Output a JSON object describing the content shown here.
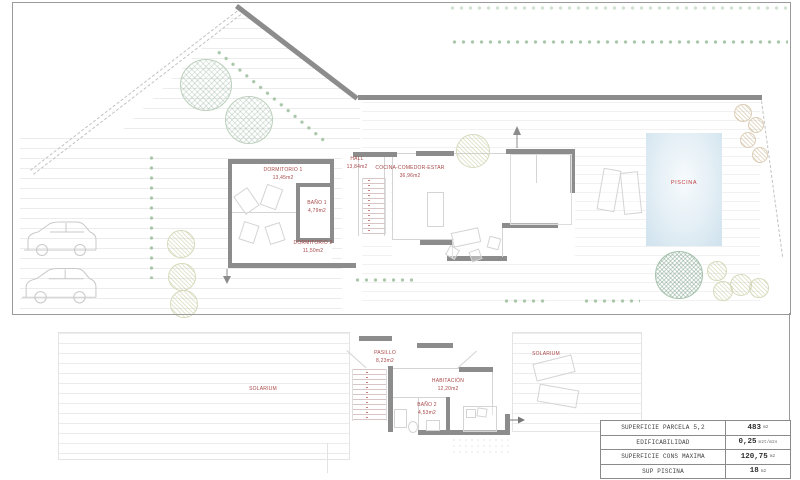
{
  "site_plan": {
    "rooms": [
      {
        "name": "DORMITORIO 1",
        "area": "13,45m2"
      },
      {
        "name": "HALL",
        "area": "13,84m2"
      },
      {
        "name": "COCINA-COMEDOR-ESTAR",
        "area": "36,96m2"
      },
      {
        "name": "BAÑO 1",
        "area": "4,79m2"
      },
      {
        "name": "DORMITORIO 2",
        "area": "11,50m2"
      }
    ],
    "pool_label": "PISCINA"
  },
  "roof_plan": {
    "rooms": [
      {
        "name": "PASILLO",
        "area": "8,23m2"
      },
      {
        "name": "HABITACIÓN",
        "area": "12,20m2"
      },
      {
        "name": "BAÑO 2",
        "area": "4,53m2"
      }
    ],
    "solarium_left": "SOLARIUM",
    "solarium_right": "SOLARIUM"
  },
  "summary_table": {
    "rows": [
      {
        "label": "SUPERFICIE PARCELA 5,2",
        "value": "483",
        "unit": "m2"
      },
      {
        "label": "EDIFICABILIDAD",
        "value": "0,25",
        "unit": "m2t/m2s"
      },
      {
        "label": "SUPERFICIE CONS MAXIMA",
        "value": "120,75",
        "unit": "m2"
      },
      {
        "label": "SUP PISCINA",
        "value": "18",
        "unit": "m2"
      }
    ]
  },
  "colors": {
    "wall": "#8c8c8c",
    "room_label": "#a84848",
    "pool_label": "#c04040",
    "pool_fill": "#d8e8f2",
    "vegetation": "#a9c6a9"
  }
}
